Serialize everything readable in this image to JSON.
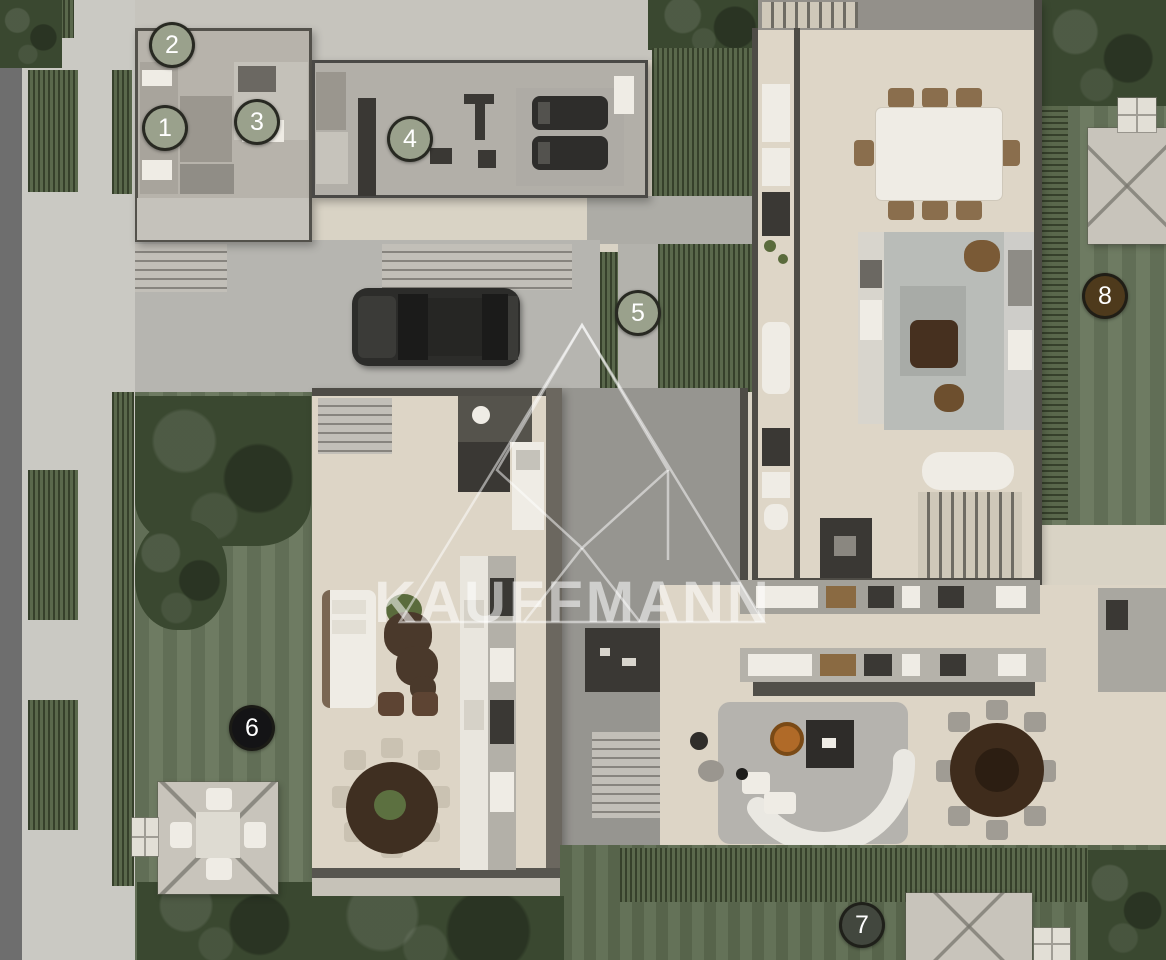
{
  "watermark": {
    "text": "KAUFFMANN",
    "logo_icon": "triangle-monogram-logo"
  },
  "markers": [
    {
      "label": "1",
      "color": "#9aa18c"
    },
    {
      "label": "2",
      "color": "#9aa18c"
    },
    {
      "label": "3",
      "color": "#9aa18c"
    },
    {
      "label": "4",
      "color": "#9aa18c"
    },
    {
      "label": "5",
      "color": "#9aa18c"
    },
    {
      "label": "6",
      "color": "#141416"
    },
    {
      "label": "7",
      "color": "#42473e"
    },
    {
      "label": "8",
      "color": "#4e3a1c"
    }
  ],
  "palette": {
    "lawn": "#68765c",
    "hedge": "#4d5c3e",
    "trees": "#3a4830",
    "floor_beige": "#ddd5c6",
    "roof_gray": "#b4b1aa",
    "concrete": "#b6b5b0",
    "wall_dark": "#4e4c46",
    "sidewalk": "#cac9c3",
    "street": "#6e6e6e",
    "wood_dark": "#3f2e1f",
    "wood_mid": "#5d4433",
    "white_furniture": "#efece5",
    "fire_pit_copper": "#b06a28",
    "marker_sage": "#9aa18c",
    "marker_black": "#141416",
    "marker_charcoal": "#42473e",
    "marker_brown": "#4e3a1c",
    "watermark_white": "rgba(255,255,255,0.55)"
  }
}
